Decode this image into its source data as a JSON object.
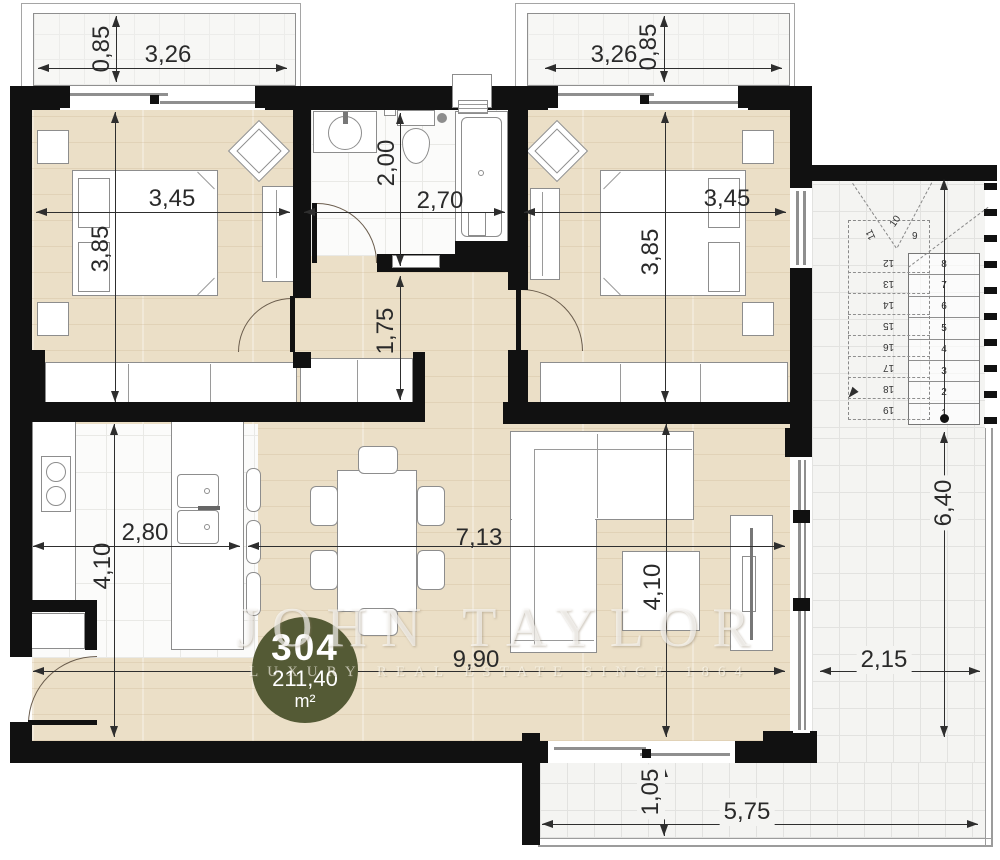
{
  "unit_badge": {
    "number": "304",
    "area_value": "211,40",
    "area_unit": "m²"
  },
  "watermark": {
    "brand": "JOHN TAYLOR",
    "tagline": "LUXURY REAL ESTATE SINCE 1864"
  },
  "dimensions": {
    "balcony_left_width": "3,26",
    "balcony_left_depth": "0,85",
    "balcony_right_width": "3,26",
    "balcony_right_depth": "0,85",
    "bedroom_left_width": "3,45",
    "bedroom_left_depth": "3,85",
    "bedroom_right_width": "3,45",
    "bedroom_right_depth": "3,85",
    "bathroom_width": "2,70",
    "bathroom_depth": "2,00",
    "hallway_length": "1,75",
    "kitchen_width": "2,80",
    "kitchen_depth": "4,10",
    "living_width": "7,13",
    "living_depth": "4,10",
    "living_total_width": "9,90",
    "terrace_right_length": "6,40",
    "terrace_right_width": "2,15",
    "terrace_bottom_depth": "1,05",
    "terrace_bottom_width": "5,75"
  },
  "stairs": {
    "flight_lower_top_to_bottom": [
      "8",
      "7",
      "6",
      "5",
      "4",
      "3",
      "2",
      "1"
    ],
    "winders": [
      "9",
      "10",
      "11"
    ],
    "flight_upper_top_to_bottom": [
      "12",
      "13",
      "14",
      "15",
      "16",
      "17",
      "18",
      "19"
    ]
  },
  "colors": {
    "badge": "#545a35",
    "wall": "#111111",
    "wood_floor": "#ebdfc7",
    "tile_floor": "#f4f4f2"
  }
}
